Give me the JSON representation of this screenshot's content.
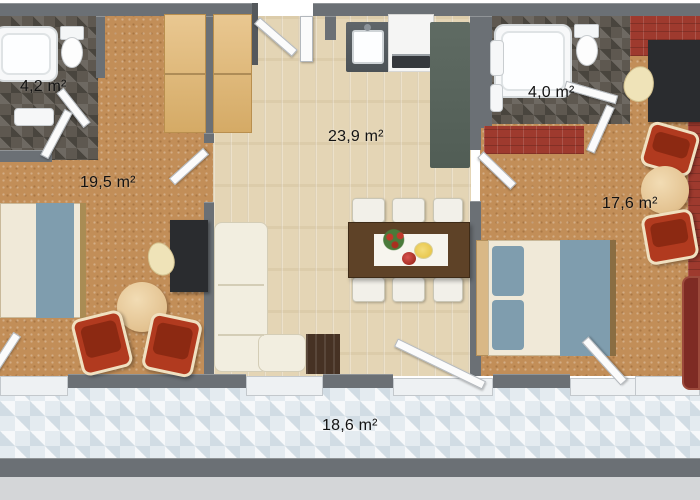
{
  "title": "Apartment floor plan (top-down 3D render)",
  "rooms": {
    "bathroom_left": {
      "name": "bathroom left",
      "area": "4,2 m²"
    },
    "bedroom_left": {
      "name": "bedroom left",
      "area": "19,5 m²"
    },
    "living_kitchen": {
      "name": "living room / kitchen",
      "area": "23,9 m²"
    },
    "bathroom_right": {
      "name": "bathroom right",
      "area": "4,0 m²"
    },
    "bedroom_right": {
      "name": "bedroom right",
      "area": "17,6 m²"
    },
    "terrace": {
      "name": "terrace",
      "area": "18,6 m²"
    }
  },
  "furniture": [
    "bathtub x2",
    "toilet x2",
    "washbasin",
    "wardrobes",
    "double bed x2",
    "desk x2",
    "red armchair x4",
    "round side table x2",
    "cream L-sofa",
    "tv cabinet",
    "kitchen sink",
    "stove with oven",
    "tall counter",
    "dining table with runner, flowers, plates",
    "dining chair x6",
    "maroon sofa",
    "pick-shaped chair"
  ],
  "palette": {
    "wall_gray": "#6b7075",
    "cork_floor": "#c28e58",
    "wood_floor": "#e4d5b5",
    "bath_tile": "#5e5850",
    "terrace_tile": "#e4ebf0",
    "accent_brick_red": "#9e3a2e",
    "armchair_red": "#b13a1f",
    "sofa_cream": "#f2eee0",
    "wardrobe_oak": "#e2b56c",
    "table_walnut": "#5e4227",
    "bed_blue": "#7f9dae"
  }
}
